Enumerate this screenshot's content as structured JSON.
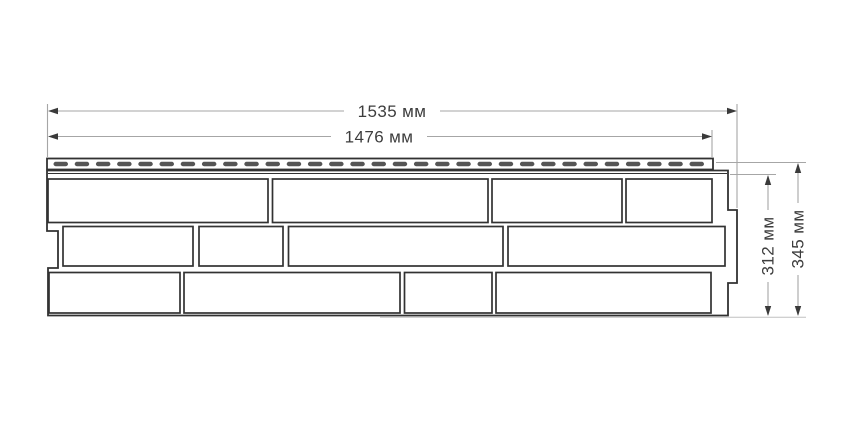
{
  "dimensions": {
    "overall_width_label": "1535 мм",
    "nominal_width_label": "1476 мм",
    "panel_height_label": "312 мм",
    "overall_height_label": "345 мм"
  },
  "panel": {
    "rows": 3,
    "bricks_per_row": 4,
    "slot_count": 31
  },
  "colors": {
    "background": "#ffffff",
    "outline": "#323232",
    "slot_fill": "#555555",
    "dim_line": "#a6a6a6",
    "arrow_fill": "#3a3a3a",
    "text": "#3d3d3d"
  }
}
